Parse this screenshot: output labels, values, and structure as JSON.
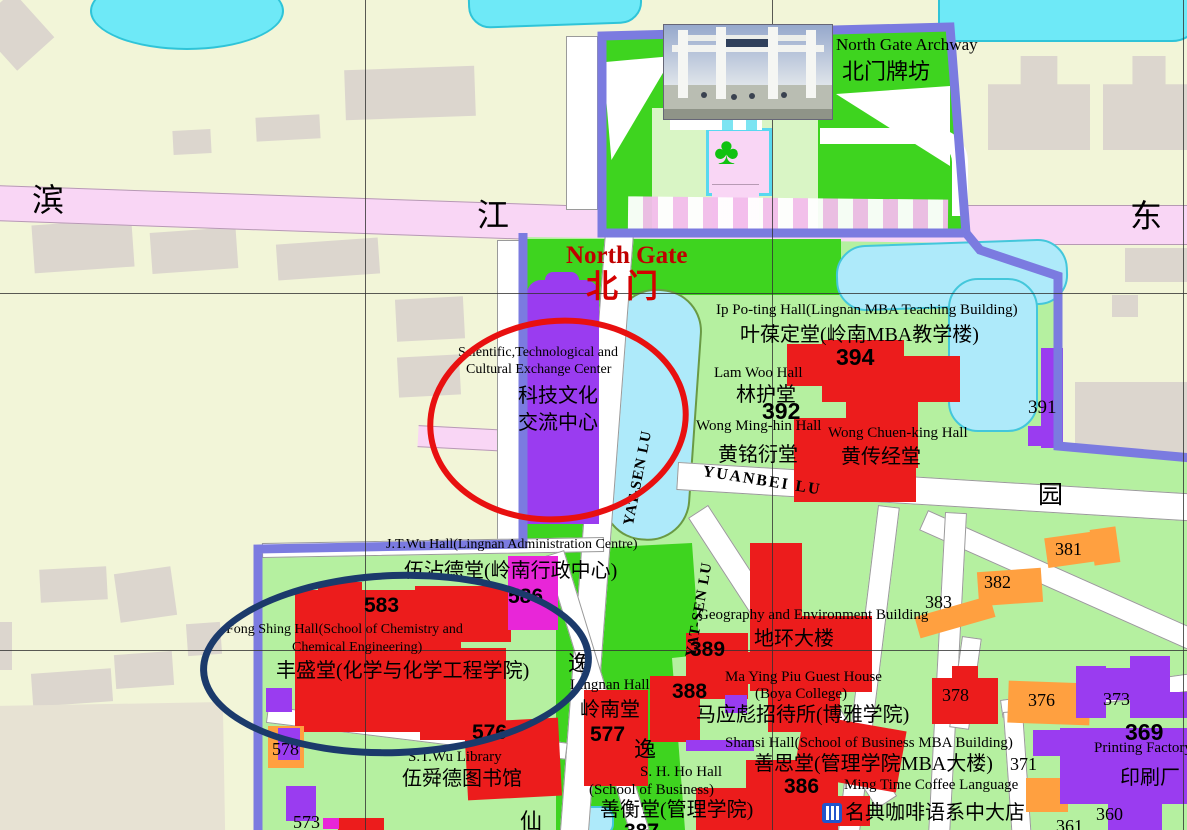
{
  "map": {
    "title": "Sun Yat-sen University — North Gate Campus Map",
    "colors": {
      "campus_green": "#3ed41f",
      "campus_light_green": "#b5f0a0",
      "outside_ground": "#f2f5d8",
      "water": "#aeeafa",
      "water_bright": "#6ee9f7",
      "road_pink": "#f9d6f5",
      "boundary_purple": "#7b7be0",
      "building_red": "#ec1c1c",
      "building_orange": "#ffa040",
      "building_purple": "#9a3cf0",
      "building_magenta": "#e826d8",
      "annotation_red_circle": "#e81010",
      "annotation_navy_circle": "#1b3a6b",
      "gate_text_red": "#c00000"
    },
    "annotations": {
      "red_circle_target": "Scientific,Technological and Cultural Exchange Center",
      "navy_circle_target": "Fong Shing Hall (School of Chemistry and Chemical Engineering)"
    },
    "icons": {
      "clover": "plaza-garden-icon",
      "restaurant": "restaurant-icon"
    }
  },
  "photo": {
    "caption_en": "North Gate Archway",
    "caption_zh": "北门牌坊"
  },
  "labels": [
    {
      "id": "road-bin",
      "text": "滨",
      "x": 32,
      "y": 184,
      "fs": 32
    },
    {
      "id": "road-jiang",
      "text": "江",
      "x": 477,
      "y": 199,
      "fs": 32
    },
    {
      "id": "road-dong",
      "text": "东",
      "x": 1130,
      "y": 200,
      "fs": 32
    },
    {
      "id": "north-gate-en",
      "text": "North Gate",
      "x": 566,
      "y": 243,
      "fs": 25,
      "w": 700,
      "color": "#c00000"
    },
    {
      "id": "north-gate-zh",
      "text": "北门",
      "x": 586,
      "y": 270,
      "fs": 32,
      "w": 700,
      "color": "#d40000",
      "ls": 8
    },
    {
      "id": "sci-center-en1",
      "text": "Scientific,Technological and",
      "x": 458,
      "y": 346,
      "fs": 14
    },
    {
      "id": "sci-center-en2",
      "text": "Cultural Exchange Center",
      "x": 466,
      "y": 363,
      "fs": 14
    },
    {
      "id": "sci-center-zh1",
      "text": "科技文化",
      "x": 518,
      "y": 386,
      "fs": 20
    },
    {
      "id": "sci-center-zh2",
      "text": "交流中心",
      "x": 518,
      "y": 413,
      "fs": 20
    },
    {
      "id": "ip-po-ting-en",
      "text": "Ip Po-ting Hall(Lingnan MBA Teaching Building)",
      "x": 716,
      "y": 303,
      "fs": 15
    },
    {
      "id": "ip-po-ting-zh",
      "text": "叶葆定堂(岭南MBA教学楼)",
      "x": 740,
      "y": 325,
      "fs": 20
    },
    {
      "id": "num-394",
      "text": "394",
      "x": 836,
      "y": 345,
      "fs": 23,
      "w": 700,
      "fam": "sans"
    },
    {
      "id": "lam-woo-en",
      "text": "Lam Woo Hall",
      "x": 714,
      "y": 366,
      "fs": 15
    },
    {
      "id": "lam-woo-zh",
      "text": "林护堂",
      "x": 736,
      "y": 385,
      "fs": 20
    },
    {
      "id": "num-392",
      "text": "392",
      "x": 762,
      "y": 399,
      "fs": 23,
      "w": 700,
      "fam": "sans"
    },
    {
      "id": "wong-ming-hin-en",
      "text": "Wong Ming-hin Hall",
      "x": 696,
      "y": 419,
      "fs": 15
    },
    {
      "id": "wong-ming-hin-zh",
      "text": "黄铭衍堂",
      "x": 718,
      "y": 445,
      "fs": 20
    },
    {
      "id": "wong-chuen-king-en",
      "text": "Wong Chuen-king Hall",
      "x": 828,
      "y": 426,
      "fs": 15
    },
    {
      "id": "wong-chuen-king-zh",
      "text": "黄传经堂",
      "x": 841,
      "y": 447,
      "fs": 20
    },
    {
      "id": "num-391",
      "text": "391",
      "x": 1028,
      "y": 398,
      "fs": 19
    },
    {
      "id": "yuanbei-lu",
      "text": "YUANBEI LU",
      "x": 704,
      "y": 464,
      "fs": 16,
      "w": 600,
      "ls": 2,
      "rot": 9
    },
    {
      "id": "yuan-char",
      "text": "园",
      "x": 1038,
      "y": 483,
      "fs": 25
    },
    {
      "id": "jt-wu-en",
      "text": "J.T.Wu Hall(Lingnan Administration Centre)",
      "x": 386,
      "y": 538,
      "fs": 14
    },
    {
      "id": "jt-wu-zh",
      "text": "伍沾德堂(岭南行政中心)",
      "x": 404,
      "y": 561,
      "fs": 20
    },
    {
      "id": "num-586",
      "text": "586",
      "x": 508,
      "y": 586,
      "fs": 21,
      "w": 700,
      "fam": "sans"
    },
    {
      "id": "num-583",
      "text": "583",
      "x": 364,
      "y": 595,
      "fs": 21,
      "w": 700,
      "fam": "sans"
    },
    {
      "id": "fong-shing-en1",
      "text": "Fong Shing Hall(School of Chemistry and",
      "x": 226,
      "y": 623,
      "fs": 14
    },
    {
      "id": "fong-shing-en2",
      "text": "Chemical Engineering)",
      "x": 292,
      "y": 641,
      "fs": 14
    },
    {
      "id": "fong-shing-zh",
      "text": "丰盛堂(化学与化学工程学院)",
      "x": 276,
      "y": 661,
      "fs": 20
    },
    {
      "id": "yi-char-1",
      "text": "逸",
      "x": 568,
      "y": 652,
      "fs": 22
    },
    {
      "id": "lingnan-hall-en",
      "text": "Lingnan Hall",
      "x": 570,
      "y": 678,
      "fs": 15
    },
    {
      "id": "lingnan-hall-zh",
      "text": "岭南堂",
      "x": 580,
      "y": 700,
      "fs": 20
    },
    {
      "id": "num-577",
      "text": "577",
      "x": 590,
      "y": 724,
      "fs": 21,
      "w": 700,
      "fam": "sans"
    },
    {
      "id": "yi-char-2",
      "text": "逸",
      "x": 634,
      "y": 738,
      "fs": 22
    },
    {
      "id": "num-578",
      "text": "578",
      "x": 272,
      "y": 740,
      "fs": 18
    },
    {
      "id": "num-576",
      "text": "576",
      "x": 472,
      "y": 722,
      "fs": 21,
      "w": 700,
      "fam": "sans"
    },
    {
      "id": "st-wu-library-en",
      "text": "S.T.Wu Library",
      "x": 408,
      "y": 750,
      "fs": 15
    },
    {
      "id": "st-wu-library-zh",
      "text": "伍舜德图书馆",
      "x": 402,
      "y": 769,
      "fs": 20
    },
    {
      "id": "num-573",
      "text": "573",
      "x": 293,
      "y": 813,
      "fs": 18
    },
    {
      "id": "yat-sen-lu-1",
      "text": "YAT-SEN LU",
      "x": 622,
      "y": 524,
      "fs": 15,
      "w": 600,
      "rot": -79,
      "ls": 1
    },
    {
      "id": "yat-sen-lu-2",
      "text": "YAT-SEN LU",
      "x": 684,
      "y": 656,
      "fs": 15,
      "w": 600,
      "rot": -80,
      "ls": 1
    },
    {
      "id": "geography-en",
      "text": "Geography and Environment Building",
      "x": 698,
      "y": 608,
      "fs": 15
    },
    {
      "id": "geography-zh",
      "text": "地环大楼",
      "x": 754,
      "y": 629,
      "fs": 20
    },
    {
      "id": "num-389",
      "text": "389",
      "x": 690,
      "y": 639,
      "fs": 21,
      "w": 700,
      "fam": "sans"
    },
    {
      "id": "ma-ying-piu-en",
      "text": "Ma Ying Piu Guest House",
      "x": 725,
      "y": 670,
      "fs": 15
    },
    {
      "id": "boya-en",
      "text": "(Boya College)",
      "x": 755,
      "y": 687,
      "fs": 15
    },
    {
      "id": "ma-ying-piu-zh",
      "text": "马应彪招待所(博雅学院)",
      "x": 696,
      "y": 705,
      "fs": 20
    },
    {
      "id": "num-388",
      "text": "388",
      "x": 672,
      "y": 681,
      "fs": 21,
      "w": 700,
      "fam": "sans"
    },
    {
      "id": "shansi-en",
      "text": "Shansi Hall(School of Business MBA Building)",
      "x": 725,
      "y": 736,
      "fs": 15
    },
    {
      "id": "shansi-zh",
      "text": "善思堂(管理学院MBA大楼)",
      "x": 754,
      "y": 754,
      "fs": 20
    },
    {
      "id": "num-386",
      "text": "386",
      "x": 784,
      "y": 776,
      "fs": 21,
      "w": 700,
      "fam": "sans"
    },
    {
      "id": "sh-ho-en1",
      "text": "S. H. Ho Hall",
      "x": 640,
      "y": 765,
      "fs": 15
    },
    {
      "id": "sh-ho-en2",
      "text": "(School of Business)",
      "x": 589,
      "y": 783,
      "fs": 15
    },
    {
      "id": "sh-ho-zh",
      "text": "善衡堂(管理学院)",
      "x": 600,
      "y": 800,
      "fs": 20
    },
    {
      "id": "num-387",
      "text": "387",
      "x": 624,
      "y": 821,
      "fs": 21,
      "w": 700,
      "fam": "sans"
    },
    {
      "id": "ming-time-en",
      "text": "Ming Time Coffee Language",
      "x": 844,
      "y": 778,
      "fs": 15
    },
    {
      "id": "ming-time-zh",
      "text": "名典咖啡语系中大店",
      "x": 845,
      "y": 803,
      "fs": 20
    },
    {
      "id": "num-381",
      "text": "381",
      "x": 1055,
      "y": 540,
      "fs": 18
    },
    {
      "id": "num-382",
      "text": "382",
      "x": 984,
      "y": 573,
      "fs": 18
    },
    {
      "id": "num-383",
      "text": "383",
      "x": 925,
      "y": 593,
      "fs": 18
    },
    {
      "id": "num-378",
      "text": "378",
      "x": 942,
      "y": 686,
      "fs": 18
    },
    {
      "id": "num-376",
      "text": "376",
      "x": 1028,
      "y": 691,
      "fs": 18
    },
    {
      "id": "num-373",
      "text": "373",
      "x": 1103,
      "y": 690,
      "fs": 18
    },
    {
      "id": "num-369",
      "text": "369",
      "x": 1125,
      "y": 720,
      "fs": 23,
      "w": 700,
      "fam": "sans"
    },
    {
      "id": "printing-factory-en",
      "text": "Printing Factory",
      "x": 1094,
      "y": 741,
      "fs": 15
    },
    {
      "id": "printing-factory-zh",
      "text": "印刷厂",
      "x": 1120,
      "y": 768,
      "fs": 20
    },
    {
      "id": "num-371",
      "text": "371",
      "x": 1010,
      "y": 755,
      "fs": 18
    },
    {
      "id": "num-360",
      "text": "360",
      "x": 1096,
      "y": 805,
      "fs": 18
    },
    {
      "id": "num-361",
      "text": "361",
      "x": 1056,
      "y": 817,
      "fs": 18
    },
    {
      "id": "xian-char",
      "text": "仙",
      "x": 520,
      "y": 810,
      "fs": 22
    }
  ]
}
